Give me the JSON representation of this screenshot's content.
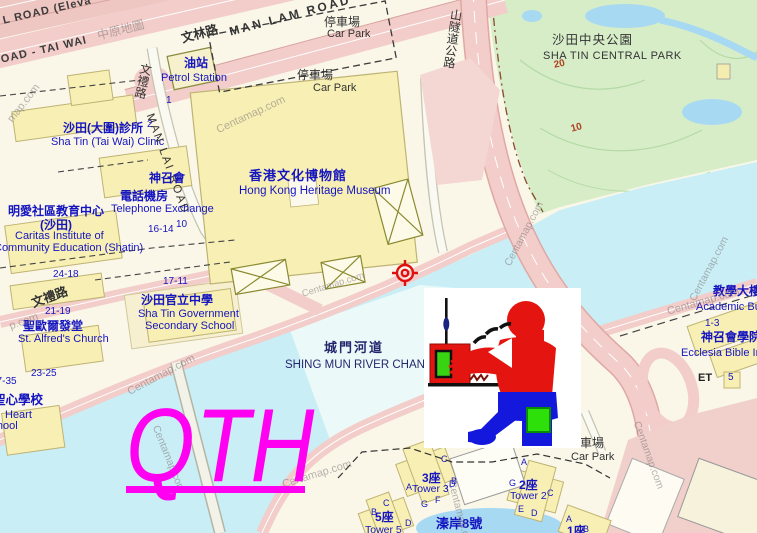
{
  "meta": {
    "title": "Centamap street map of Sha Tin with QTH marker"
  },
  "colors": {
    "land": "#faf7e9",
    "park": "#d6edc8",
    "pond": "#a8d9f2",
    "river": "#c9eef6",
    "roadpink": "#f2cdc9",
    "roadpinkedge": "#dfa8a2",
    "bldg": "#f7efb4",
    "bldgedge": "#bfb373",
    "whiteroad": "#fbfaf2",
    "roadcase": "#c4c4b2",
    "magenta": "#ff00f0",
    "blue": "#1515c0"
  },
  "overlay": {
    "qth_text": "QTH",
    "crosshair_color": "#e01010",
    "cartoon": "ham radio operator clipart"
  },
  "labels": [
    {
      "t": "L ROAD (Eleva",
      "x": 2,
      "y": 16,
      "fs": 11,
      "c": "#3c3c3c",
      "r": -13,
      "w": 700,
      "ls": 1,
      "name": "label-road-elevated"
    },
    {
      "t": "OAD - TAI WAI",
      "x": 0,
      "y": 55,
      "fs": 11,
      "c": "#3c3c3c",
      "r": -13,
      "w": 700,
      "ls": 1,
      "name": "label-road-tai-wai"
    },
    {
      "t": "文林路",
      "x": 180,
      "y": 33,
      "fs": 12.5,
      "c": "#333333",
      "r": -15,
      "w": 700,
      "name": "label-man-lam-road-zh"
    },
    {
      "t": "MAN LAM ROAD",
      "x": 228,
      "y": 26,
      "fs": 12,
      "c": "#333333",
      "r": -15,
      "w": 700,
      "ls": 2.5,
      "name": "label-man-lam-road"
    },
    {
      "t": "停車場",
      "x": 324,
      "y": 16,
      "fs": 12,
      "c": "#333333",
      "name": "label-car-park-1-zh"
    },
    {
      "t": "Car Park",
      "x": 327,
      "y": 29,
      "fs": 11,
      "c": "#333333",
      "name": "label-car-park-1"
    },
    {
      "t": "停車場",
      "x": 297,
      "y": 69,
      "fs": 12,
      "c": "#333333",
      "name": "label-car-park-2-zh"
    },
    {
      "t": "Car Park",
      "x": 313,
      "y": 83,
      "fs": 11,
      "c": "#333333",
      "name": "label-car-park-2"
    },
    {
      "t": "油站",
      "x": 184,
      "y": 57,
      "fs": 12,
      "c": "#1515c0",
      "w": 700,
      "name": "label-petrol-station-zh"
    },
    {
      "t": "Petrol Station",
      "x": 161,
      "y": 73,
      "fs": 11,
      "c": "#1515c0",
      "name": "label-petrol-station"
    },
    {
      "t": "1",
      "x": 166,
      "y": 96,
      "fs": 10,
      "c": "#1515c0",
      "name": "label-number-1"
    },
    {
      "t": "山隧道公路",
      "x": 450,
      "y": 8,
      "fs": 12,
      "c": "#333333",
      "vm": 1,
      "r": 8,
      "name": "label-tunnel-highway-zh"
    },
    {
      "t": "沙田中央公園",
      "x": 552,
      "y": 34,
      "fs": 12.5,
      "c": "#333333",
      "ls": 1,
      "name": "label-central-park-zh"
    },
    {
      "t": "SHA TIN CENTRAL PARK",
      "x": 543,
      "y": 51,
      "fs": 11,
      "c": "#333333",
      "ls": 0.5,
      "name": "label-central-park"
    },
    {
      "t": "20",
      "x": 553,
      "y": 61,
      "fs": 10,
      "c": "#b04020",
      "r": -12,
      "w": 700,
      "name": "label-contour-20"
    },
    {
      "t": "10",
      "x": 570,
      "y": 125,
      "fs": 10,
      "c": "#b04020",
      "r": -15,
      "w": 700,
      "name": "label-contour-10"
    },
    {
      "t": "沙田(大圍)診所",
      "x": 63,
      "y": 122,
      "fs": 12,
      "c": "#1515c0",
      "w": 700,
      "name": "label-clinic-zh"
    },
    {
      "t": "2",
      "x": 147,
      "y": 120,
      "fs": 10,
      "c": "#1515c0",
      "name": "label-number-2"
    },
    {
      "t": "Sha Tin (Tai Wai) Clinic",
      "x": 51,
      "y": 137,
      "fs": 11,
      "c": "#1515c0",
      "name": "label-clinic"
    },
    {
      "t": "文禮路",
      "x": 140,
      "y": 62,
      "fs": 12,
      "c": "#333333",
      "vm": 1,
      "r": 12,
      "name": "label-man-lai-road-zh"
    },
    {
      "t": "MAN LAI ROAD",
      "x": 155,
      "y": 112,
      "fs": 11.5,
      "c": "#333333",
      "r": 70,
      "ls": 2,
      "name": "label-man-lai-road"
    },
    {
      "t": "神召會",
      "x": 149,
      "y": 172,
      "fs": 12,
      "c": "#1515c0",
      "w": 700,
      "name": "label-assembly-of-god-zh"
    },
    {
      "t": "電話機房",
      "x": 120,
      "y": 190,
      "fs": 12,
      "c": "#1515c0",
      "w": 700,
      "name": "label-telephone-exchange-zh"
    },
    {
      "t": "Telephone Exchange",
      "x": 111,
      "y": 204,
      "fs": 11,
      "c": "#1515c0",
      "name": "label-telephone-exchange"
    },
    {
      "t": "16-14",
      "x": 148,
      "y": 225,
      "fs": 10,
      "c": "#1515c0",
      "name": "label-number-16-14"
    },
    {
      "t": "10",
      "x": 176,
      "y": 220,
      "fs": 10,
      "c": "#1515c0",
      "name": "label-number-10"
    },
    {
      "t": "明愛社區教育中心",
      "x": 8,
      "y": 205,
      "fs": 12,
      "c": "#1515c0",
      "w": 700,
      "name": "label-caritas-zh"
    },
    {
      "t": "(沙田)",
      "x": 40,
      "y": 219,
      "fs": 12,
      "c": "#1515c0",
      "w": 700,
      "name": "label-caritas-zh2"
    },
    {
      "t": "Caritas Institute of",
      "x": 15,
      "y": 231,
      "fs": 11,
      "c": "#1515c0",
      "name": "label-caritas-1"
    },
    {
      "t": "Community Education (Shatin)",
      "x": -6,
      "y": 243,
      "fs": 11,
      "c": "#1515c0",
      "name": "label-caritas-2"
    },
    {
      "t": "24-18",
      "x": 53,
      "y": 270,
      "fs": 10,
      "c": "#1515c0",
      "name": "label-number-24-18"
    },
    {
      "t": "文禮路",
      "x": 30,
      "y": 298,
      "fs": 12.5,
      "c": "#333333",
      "r": -20,
      "w": 700,
      "name": "label-man-lai-road-zh-2"
    },
    {
      "t": "21-19",
      "x": 45,
      "y": 307,
      "fs": 10,
      "c": "#1515c0",
      "name": "label-number-21-19"
    },
    {
      "t": "聖歐爾發堂",
      "x": 23,
      "y": 320,
      "fs": 12,
      "c": "#1515c0",
      "w": 700,
      "name": "label-st-alfreds-zh"
    },
    {
      "t": "St. Alfred's Church",
      "x": 18,
      "y": 334,
      "fs": 11,
      "c": "#1515c0",
      "name": "label-st-alfreds"
    },
    {
      "t": "17-11",
      "x": 163,
      "y": 277,
      "fs": 10,
      "c": "#1515c0",
      "name": "label-number-17-11"
    },
    {
      "t": "沙田官立中學",
      "x": 141,
      "y": 294,
      "fs": 12,
      "c": "#1515c0",
      "w": 700,
      "name": "label-govt-school-zh"
    },
    {
      "t": "Sha Tin Government",
      "x": 138,
      "y": 309,
      "fs": 11,
      "c": "#1515c0",
      "name": "label-govt-school-1"
    },
    {
      "t": "Secondary School",
      "x": 145,
      "y": 321,
      "fs": 11,
      "c": "#1515c0",
      "name": "label-govt-school-2"
    },
    {
      "t": "23-25",
      "x": 31,
      "y": 369,
      "fs": 10,
      "c": "#1515c0",
      "name": "label-number-23-25"
    },
    {
      "t": "37-35",
      "x": -9,
      "y": 377,
      "fs": 10,
      "c": "#1515c0",
      "name": "label-number-37-35"
    },
    {
      "t": "聖心學校",
      "x": -7,
      "y": 394,
      "fs": 12.5,
      "c": "#1515c0",
      "w": 700,
      "name": "label-sacred-heart-zh"
    },
    {
      "t": "Heart",
      "x": 5,
      "y": 410,
      "fs": 11,
      "c": "#1515c0",
      "name": "label-sacred-heart-1"
    },
    {
      "t": "School",
      "x": -16,
      "y": 421,
      "fs": 11,
      "c": "#1515c0",
      "name": "label-sacred-heart-2"
    },
    {
      "t": "香港文化博物館",
      "x": 249,
      "y": 169,
      "fs": 13,
      "c": "#1515c0",
      "w": 700,
      "ls": 1,
      "name": "label-heritage-museum-zh"
    },
    {
      "t": "Hong Kong Heritage Museum",
      "x": 239,
      "y": 185,
      "fs": 11.5,
      "c": "#1515c0",
      "name": "label-heritage-museum"
    },
    {
      "t": "城門河道",
      "x": 324,
      "y": 341,
      "fs": 13,
      "c": "#26266e",
      "w": 700,
      "ls": 2,
      "name": "label-river-zh"
    },
    {
      "t": "SHING MUN RIVER CHANNEL",
      "x": 285,
      "y": 359,
      "fs": 11.5,
      "c": "#26266e",
      "name": "label-river"
    },
    {
      "t": "教學大樓",
      "x": 713,
      "y": 285,
      "fs": 12,
      "c": "#1515c0",
      "w": 700,
      "name": "label-academic-zh"
    },
    {
      "t": "Academic Building",
      "x": 696,
      "y": 302,
      "fs": 11,
      "c": "#1515c0",
      "name": "label-academic"
    },
    {
      "t": "1-3",
      "x": 705,
      "y": 319,
      "fs": 10,
      "c": "#1515c0",
      "name": "label-number-1-3"
    },
    {
      "t": "神召會學院",
      "x": 701,
      "y": 331,
      "fs": 12,
      "c": "#1515c0",
      "w": 700,
      "name": "label-ecclesia-zh"
    },
    {
      "t": "Ecclesia Bible Institute",
      "x": 681,
      "y": 348,
      "fs": 11,
      "c": "#1515c0",
      "name": "label-ecclesia"
    },
    {
      "t": "ET",
      "x": 698,
      "y": 373,
      "fs": 11,
      "c": "#222222",
      "w": 700,
      "name": "label-et"
    },
    {
      "t": "5",
      "x": 728,
      "y": 373,
      "fs": 10,
      "c": "#1515c0",
      "name": "label-number-5"
    },
    {
      "t": "車場",
      "x": 580,
      "y": 437,
      "fs": 12,
      "c": "#333333",
      "name": "label-car-park-3-zh"
    },
    {
      "t": "Car Park",
      "x": 571,
      "y": 452,
      "fs": 11,
      "c": "#333333",
      "name": "label-car-park-3"
    },
    {
      "t": "3座",
      "x": 422,
      "y": 472,
      "fs": 12,
      "c": "#1515c0",
      "w": 700,
      "name": "label-tower-3-zh"
    },
    {
      "t": "Tower 3",
      "x": 412,
      "y": 484,
      "fs": 10.5,
      "c": "#1515c0",
      "name": "label-tower-3"
    },
    {
      "t": "2座",
      "x": 519,
      "y": 479,
      "fs": 12,
      "c": "#1515c0",
      "w": 700,
      "name": "label-tower-2-zh"
    },
    {
      "t": "Tower 2",
      "x": 510,
      "y": 491,
      "fs": 10.5,
      "c": "#1515c0",
      "name": "label-tower-2"
    },
    {
      "t": "5座",
      "x": 375,
      "y": 511,
      "fs": 12,
      "c": "#1515c0",
      "w": 700,
      "name": "label-tower-5-zh"
    },
    {
      "t": "Tower 5",
      "x": 365,
      "y": 525,
      "fs": 10.5,
      "c": "#1515c0",
      "name": "label-tower-5"
    },
    {
      "t": "1座",
      "x": 567,
      "y": 525,
      "fs": 12,
      "c": "#1515c0",
      "w": 700,
      "name": "label-tower-1-zh"
    },
    {
      "t": "溱岸8號",
      "x": 436,
      "y": 517,
      "fs": 13,
      "c": "#1515c0",
      "w": 700,
      "name": "label-riverpark-zh"
    }
  ],
  "unit_letters": [
    {
      "t": "C",
      "x": 441,
      "y": 455
    },
    {
      "t": "B",
      "x": 451,
      "y": 477
    },
    {
      "t": "A",
      "x": 406,
      "y": 483
    },
    {
      "t": "D",
      "x": 449,
      "y": 480
    },
    {
      "t": "F",
      "x": 435,
      "y": 496
    },
    {
      "t": "G",
      "x": 421,
      "y": 500
    },
    {
      "t": "C",
      "x": 383,
      "y": 499
    },
    {
      "t": "B",
      "x": 371,
      "y": 508
    },
    {
      "t": "D",
      "x": 405,
      "y": 519
    },
    {
      "t": "A",
      "x": 521,
      "y": 458
    },
    {
      "t": "G",
      "x": 509,
      "y": 479
    },
    {
      "t": "C",
      "x": 547,
      "y": 489
    },
    {
      "t": "E",
      "x": 518,
      "y": 505
    },
    {
      "t": "D",
      "x": 531,
      "y": 509
    },
    {
      "t": "A",
      "x": 566,
      "y": 515
    },
    {
      "t": "B",
      "x": 583,
      "y": 525
    }
  ],
  "watermarks": [
    {
      "t": "中原地圖",
      "x": 96,
      "y": 30,
      "r": -14,
      "fs": 12
    },
    {
      "t": "map.com",
      "x": 6,
      "y": 118,
      "r": -52
    },
    {
      "t": "Centamap.com",
      "x": 215,
      "y": 126,
      "r": -25
    },
    {
      "t": "Centamap.com",
      "x": 301,
      "y": 290,
      "r": -17,
      "fs": 9.5
    },
    {
      "t": "Centamap.com",
      "x": 503,
      "y": 263,
      "r": -62,
      "fs": 10.5
    },
    {
      "t": "Centamap.com",
      "x": 666,
      "y": 307,
      "r": -16
    },
    {
      "t": "Centamap.com",
      "x": 688,
      "y": 298,
      "r": -62,
      "fs": 10.5
    },
    {
      "t": "Centamap.com",
      "x": 126,
      "y": 388,
      "r": -28
    },
    {
      "t": "Centamap.com",
      "x": 160,
      "y": 424,
      "r": 68,
      "fs": 10.5
    },
    {
      "t": "Certamap.com",
      "x": 281,
      "y": 480,
      "r": -17
    },
    {
      "t": "Centamap.com",
      "x": 641,
      "y": 420,
      "r": 70,
      "fs": 10.5
    },
    {
      "t": "Centamap.com",
      "x": 456,
      "y": 480,
      "r": 75,
      "fs": 10.5
    },
    {
      "t": "p.com",
      "x": 8,
      "y": 322,
      "r": -20
    }
  ]
}
